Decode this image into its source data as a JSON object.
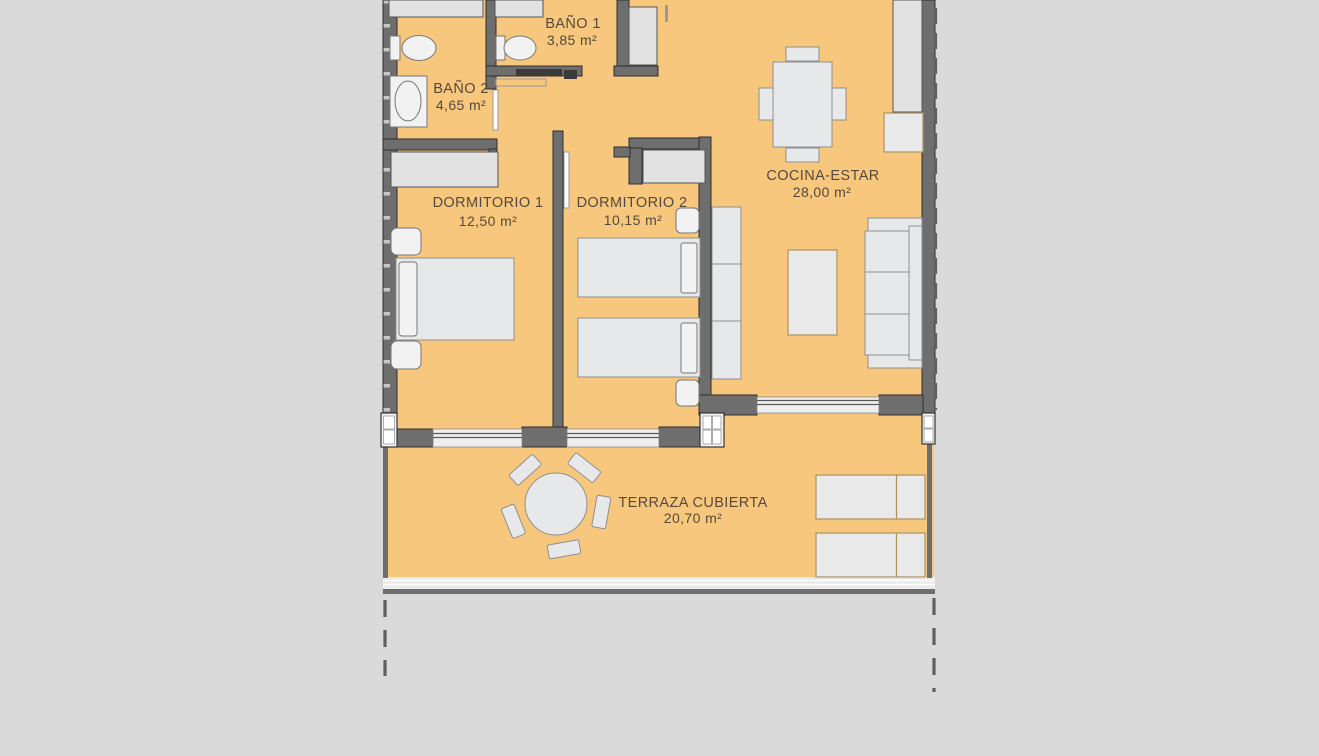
{
  "plan": {
    "rooms": [
      {
        "id": "bano-1",
        "name": "BAÑO 1",
        "area": "3,85 m²"
      },
      {
        "id": "bano-2",
        "name": "BAÑO 2",
        "area": "4,65 m²"
      },
      {
        "id": "dorm-1",
        "name": "DORMITORIO 1",
        "area": "12,50 m²"
      },
      {
        "id": "dorm-2",
        "name": "DORMITORIO 2",
        "area": "10,15 m²"
      },
      {
        "id": "cocina",
        "name": "COCINA-ESTAR",
        "area": "28,00 m²"
      },
      {
        "id": "terraza",
        "name": "TERRAZA CUBIERTA",
        "area": "20,70 m²"
      }
    ],
    "colors": {
      "background": "#dadada",
      "floor": "#f6c77d",
      "wall": "#6e6e6e",
      "furniture": "#e7e8ea",
      "accent_outline": "#ab935f",
      "text": "#57493e"
    }
  }
}
